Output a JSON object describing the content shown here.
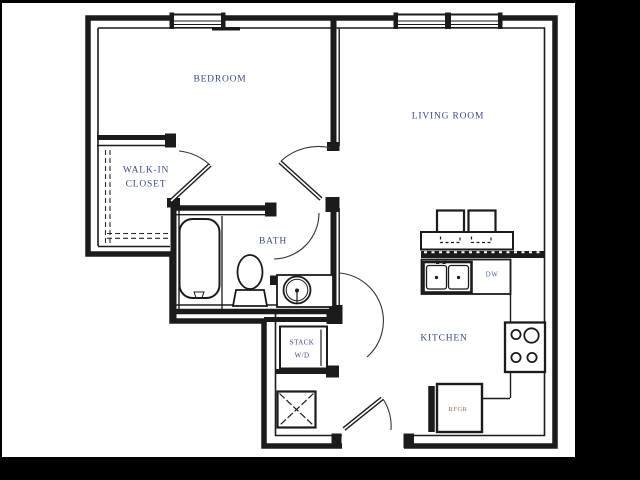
{
  "rooms": {
    "bedroom": {
      "label": "BEDROOM"
    },
    "walk_in_closet": {
      "label_line1": "WALK-IN",
      "label_line2": "CLOSET"
    },
    "living_room": {
      "label": "LIVING ROOM"
    },
    "bath": {
      "label": "BATH"
    },
    "kitchen": {
      "label": "KITCHEN"
    }
  },
  "appliances": {
    "washer_dryer": {
      "label_line1": "STACK",
      "label_line2": "W/D"
    },
    "dishwasher": {
      "label": "DW"
    },
    "refrigerator": {
      "label": "RFGR"
    }
  },
  "fixture_glyphs": [
    "bathtub",
    "toilet",
    "vanity-sink",
    "stack-washer-dryer",
    "linen-closet",
    "kitchen-double-sink",
    "cooktop",
    "refrigerator",
    "bar-stools",
    "breakfast-counter",
    "windows",
    "door-swings",
    "closet-rod-dashes"
  ],
  "colors": {
    "wall": "#1b1b1b",
    "sheet_background": "#ffffff",
    "matte_background": "#000000",
    "room_label": "#3a4a85",
    "dishwasher_label": "#4c5fa8",
    "refrigerator_label": "#9a6b55"
  }
}
